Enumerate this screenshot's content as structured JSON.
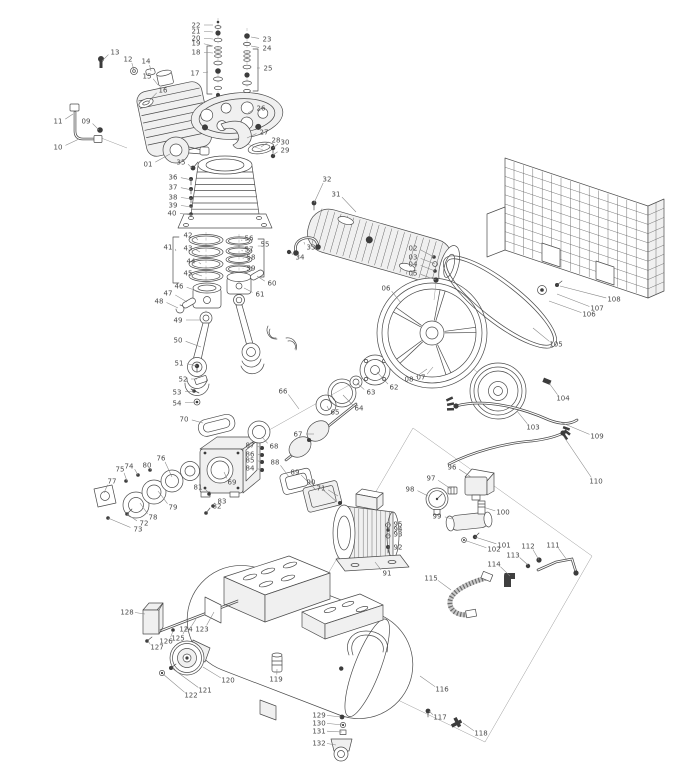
{
  "page": {
    "background": "#ffffff",
    "ink_color": "#4b4b4b",
    "label_color": "#4a4a4a",
    "leader_color": "#858585"
  },
  "diagram": {
    "type": "exploded-parts-diagram",
    "callouts": [
      [
        "01",
        148,
        164,
        170,
        154
      ],
      [
        "02",
        413,
        248,
        434,
        257
      ],
      [
        "03",
        413,
        257,
        435,
        264
      ],
      [
        "04",
        413,
        264,
        435,
        271
      ],
      [
        "05",
        413,
        273,
        436,
        280
      ],
      [
        "06",
        386,
        288,
        401,
        303
      ],
      [
        "07",
        421,
        377,
        433,
        367
      ],
      [
        "08",
        409,
        379,
        427,
        369
      ],
      [
        "09",
        86,
        121,
        99,
        130
      ],
      [
        "10",
        58,
        147,
        79,
        139
      ],
      [
        "11",
        58,
        121,
        73,
        114
      ],
      [
        "12",
        128,
        59,
        134,
        70
      ],
      [
        "13",
        115,
        52,
        102,
        61
      ],
      [
        "14",
        146,
        61,
        151,
        71
      ],
      [
        "15",
        147,
        76,
        158,
        85
      ],
      [
        "16",
        163,
        90,
        149,
        101
      ],
      [
        "17",
        195,
        73,
        208,
        72
      ],
      [
        "18",
        196,
        52,
        213,
        53
      ],
      [
        "19",
        196,
        43,
        213,
        46
      ],
      [
        "20",
        196,
        38,
        213,
        39
      ],
      [
        "21",
        196,
        31,
        213,
        32
      ],
      [
        "22",
        196,
        25,
        213,
        25
      ],
      [
        "23",
        267,
        39,
        251,
        37
      ],
      [
        "24",
        267,
        48,
        251,
        46
      ],
      [
        "25",
        268,
        68,
        257,
        68
      ],
      [
        "26",
        261,
        108,
        248,
        113
      ],
      [
        "27",
        264,
        132,
        247,
        138
      ],
      [
        "28",
        276,
        140,
        261,
        147
      ],
      [
        "29",
        285,
        150,
        273,
        155
      ],
      [
        "30",
        285,
        142,
        273,
        148
      ],
      [
        "31",
        336,
        194,
        356,
        212
      ],
      [
        "32",
        327,
        179,
        314,
        203
      ],
      [
        "33",
        311,
        247,
        304,
        242
      ],
      [
        "34",
        300,
        257,
        291,
        252
      ],
      [
        "35",
        181,
        162,
        192,
        168
      ],
      [
        "36",
        173,
        177,
        192,
        180
      ],
      [
        "37",
        173,
        187,
        192,
        190
      ],
      [
        "38",
        173,
        197,
        192,
        199
      ],
      [
        "39",
        173,
        205,
        192,
        207
      ],
      [
        "40",
        172,
        213,
        192,
        215
      ],
      [
        "41",
        168,
        247,
        176,
        251
      ],
      [
        "42",
        188,
        235,
        198,
        240
      ],
      [
        "43",
        188,
        248,
        200,
        252
      ],
      [
        "44",
        191,
        261,
        201,
        264
      ],
      [
        "45",
        188,
        273,
        202,
        276
      ],
      [
        "46",
        179,
        286,
        200,
        292
      ],
      [
        "47",
        168,
        293,
        187,
        302
      ],
      [
        "48",
        159,
        301,
        178,
        308
      ],
      [
        "49",
        178,
        320,
        200,
        320
      ],
      [
        "50",
        178,
        340,
        201,
        347
      ],
      [
        "51",
        179,
        363,
        197,
        366
      ],
      [
        "52",
        183,
        379,
        197,
        379
      ],
      [
        "53",
        177,
        392,
        194,
        391
      ],
      [
        "54",
        177,
        403,
        196,
        402
      ],
      [
        "55",
        265,
        244,
        261,
        246
      ],
      [
        "56",
        249,
        238,
        242,
        241
      ],
      [
        "57",
        249,
        249,
        243,
        251
      ],
      [
        "58",
        251,
        257,
        243,
        259
      ],
      [
        "59",
        251,
        268,
        243,
        269
      ],
      [
        "60",
        272,
        283,
        257,
        276
      ],
      [
        "61",
        260,
        294,
        244,
        288
      ],
      [
        "62",
        394,
        387,
        377,
        372
      ],
      [
        "63",
        371,
        392,
        357,
        383
      ],
      [
        "64",
        359,
        408,
        343,
        395
      ],
      [
        "65",
        335,
        412,
        327,
        406
      ],
      [
        "66",
        283,
        391,
        299,
        409
      ],
      [
        "67",
        298,
        434,
        314,
        434
      ],
      [
        "68",
        274,
        446,
        262,
        437
      ],
      [
        "69",
        232,
        482,
        224,
        472
      ],
      [
        "70",
        184,
        419,
        203,
        423
      ],
      [
        "71",
        321,
        488,
        338,
        496
      ],
      [
        "72",
        144,
        523,
        127,
        514
      ],
      [
        "73",
        138,
        529,
        108,
        518
      ],
      [
        "74",
        129,
        466,
        138,
        475
      ],
      [
        "75",
        120,
        469,
        127,
        481
      ],
      [
        "76",
        161,
        458,
        172,
        477
      ],
      [
        "77",
        112,
        481,
        104,
        493
      ],
      [
        "78",
        153,
        517,
        140,
        503
      ],
      [
        "79",
        173,
        507,
        158,
        491
      ],
      [
        "80",
        147,
        465,
        150,
        470
      ],
      [
        "81",
        198,
        487,
        208,
        492
      ],
      [
        "82",
        217,
        506,
        207,
        512
      ],
      [
        "83",
        222,
        501,
        213,
        505
      ],
      [
        "84",
        250,
        468,
        261,
        470
      ],
      [
        "85",
        250,
        460,
        261,
        462
      ],
      [
        "86",
        250,
        454,
        261,
        455
      ],
      [
        "87",
        250,
        445,
        261,
        448
      ],
      [
        "88",
        275,
        462,
        289,
        477
      ],
      [
        "89",
        295,
        472,
        316,
        490
      ],
      [
        "90",
        311,
        482,
        337,
        502
      ],
      [
        "91",
        387,
        573,
        375,
        562
      ],
      [
        "92",
        398,
        547,
        388,
        547
      ],
      [
        "93",
        398,
        534,
        388,
        536
      ],
      [
        "94",
        398,
        529,
        388,
        530
      ],
      [
        "95",
        398,
        524,
        388,
        525
      ],
      [
        "96",
        452,
        467,
        471,
        477
      ],
      [
        "97",
        431,
        478,
        451,
        489
      ],
      [
        "98",
        410,
        489,
        428,
        496
      ],
      [
        "99",
        437,
        516,
        452,
        519
      ],
      [
        "100",
        503,
        512,
        483,
        507
      ],
      [
        "101",
        504,
        545,
        475,
        537
      ],
      [
        "102",
        494,
        549,
        464,
        540
      ],
      [
        "103",
        533,
        427,
        517,
        411
      ],
      [
        "104",
        563,
        398,
        549,
        383
      ],
      [
        "105",
        556,
        344,
        533,
        328
      ],
      [
        "106",
        589,
        314,
        549,
        301
      ],
      [
        "107",
        597,
        308,
        557,
        294
      ],
      [
        "108",
        614,
        299,
        560,
        286
      ],
      [
        "109",
        597,
        436,
        560,
        422
      ],
      [
        "110",
        596,
        481,
        564,
        437
      ],
      [
        "111",
        553,
        545,
        567,
        560
      ],
      [
        "112",
        528,
        546,
        539,
        560
      ],
      [
        "113",
        513,
        555,
        528,
        565
      ],
      [
        "114",
        494,
        564,
        510,
        576
      ],
      [
        "115",
        431,
        578,
        451,
        590
      ],
      [
        "116",
        442,
        689,
        420,
        676
      ],
      [
        "117",
        440,
        717,
        429,
        711
      ],
      [
        "118",
        481,
        733,
        463,
        723
      ],
      [
        "119",
        276,
        679,
        277,
        669
      ],
      [
        "120",
        228,
        680,
        203,
        667
      ],
      [
        "121",
        205,
        690,
        173,
        669
      ],
      [
        "122",
        191,
        695,
        163,
        674
      ],
      [
        "123",
        202,
        629,
        214,
        612
      ],
      [
        "124",
        186,
        629,
        196,
        619
      ],
      [
        "125",
        178,
        638,
        187,
        626
      ],
      [
        "126",
        166,
        641,
        173,
        631
      ],
      [
        "127",
        157,
        647,
        148,
        641
      ],
      [
        "128",
        127,
        612,
        145,
        614
      ],
      [
        "129",
        319,
        715,
        341,
        717
      ],
      [
        "130",
        319,
        723,
        343,
        725
      ],
      [
        "131",
        319,
        731,
        342,
        732
      ],
      [
        "132",
        319,
        743,
        336,
        745
      ]
    ]
  }
}
